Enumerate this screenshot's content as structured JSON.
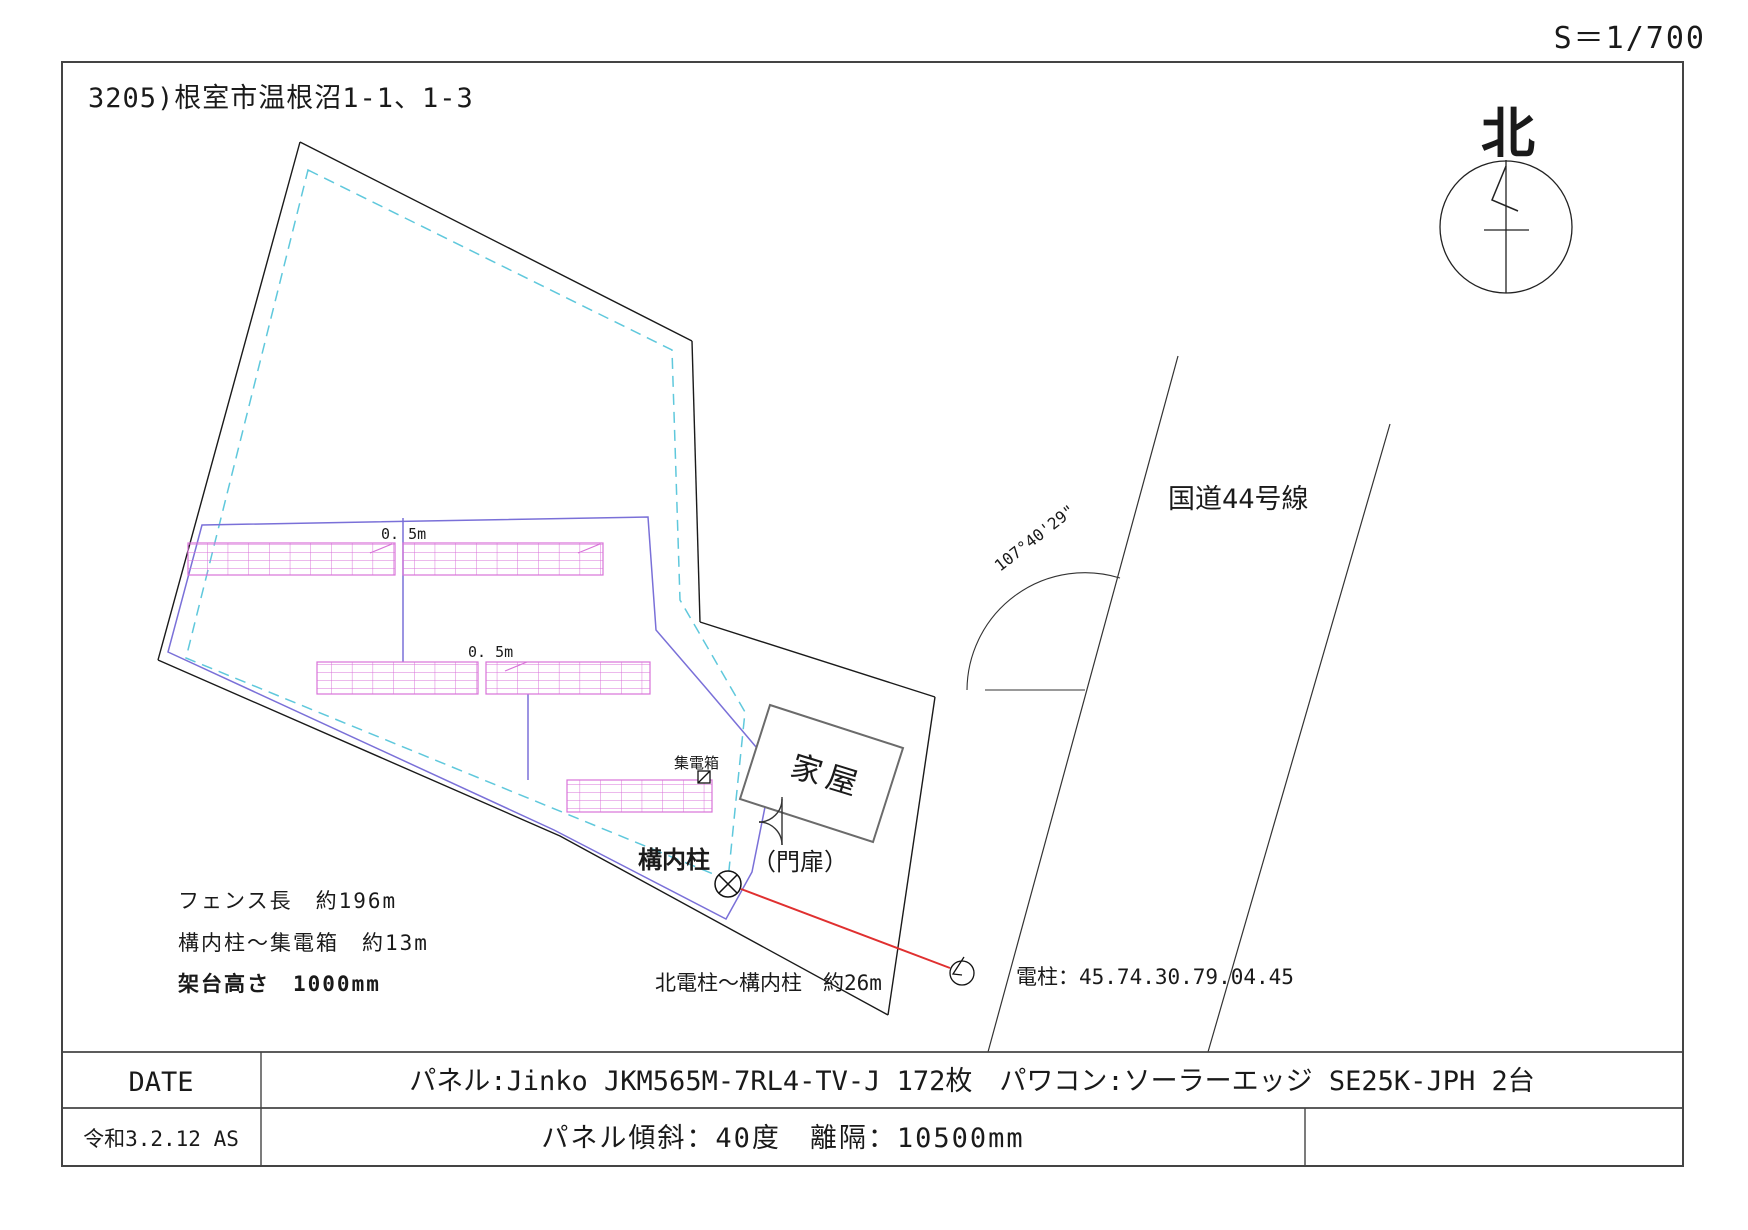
{
  "drawing": {
    "scale": "S＝1/700",
    "title": "3205)根室市温根沼1-1、1-3",
    "north_label": "北"
  },
  "site": {
    "gap_label_1": "0. 5m",
    "gap_label_2": "0. 5m",
    "collector_box": "集電箱",
    "house": "家屋",
    "premises_pole": "構内柱",
    "gate": "（門扉）",
    "fence_note": "フェンス長　約196m",
    "pole_to_box_note": "構内柱～集電箱　約13m",
    "mount_height_note": "架台高さ　1000mm",
    "north_pole_distance": "北電柱～構内柱　約26m",
    "utility_pole_id": "電柱：45.74.30.79.04.45"
  },
  "road": {
    "name": "国道44号線",
    "angle": "107°40'29\""
  },
  "title_block": {
    "date_label": "DATE",
    "date_value": "令和3.2.12 AS",
    "equipment_spec": "パネル:Jinko JKM565M-7RL4-TV-J 172枚　パワコン:ソーラーエッジ SE25K-JPH 2台",
    "tilt_spec": "パネル傾斜：40度　離隔：10500mm"
  },
  "colors": {
    "panel_magenta": "#d873d8",
    "fence_blue": "#7a70d8",
    "setback_dashed_cyan": "#5fc8dc",
    "cable_red": "#e03030",
    "boundary_black": "#1a1a1a",
    "house_gray": "#8a8a8a"
  }
}
